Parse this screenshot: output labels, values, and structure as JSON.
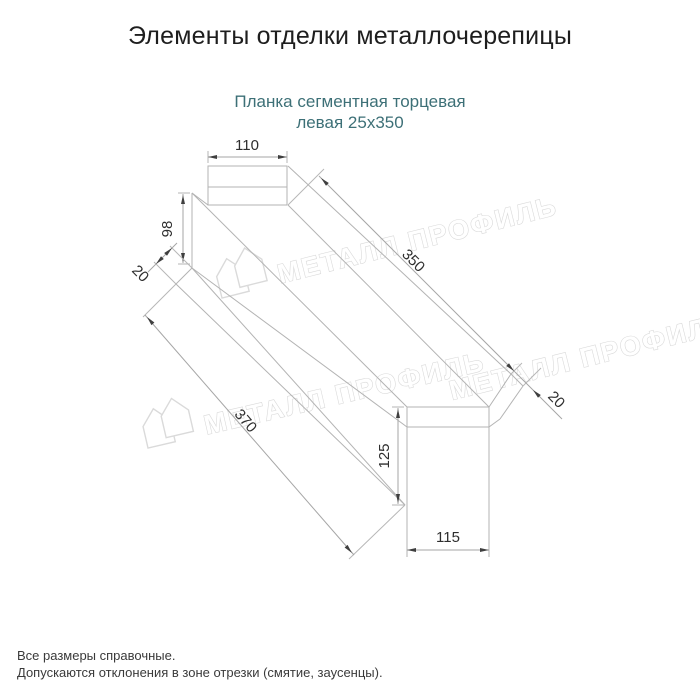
{
  "header": {
    "title": "Элементы отделки металлочерепицы"
  },
  "product": {
    "line1": "Планка сегментная торцевая",
    "line2": "левая 25х350"
  },
  "drawing": {
    "dim_top_width": "110",
    "dim_left_height": "98",
    "dim_left_flange": "20",
    "dim_length_top": "350",
    "dim_length_bottom": "370",
    "dim_right_flange": "20",
    "dim_right_height": "125",
    "dim_bottom_width": "115"
  },
  "watermark": {
    "text": "МЕТАЛЛ ПРОФИЛЬ"
  },
  "footer": {
    "line1": "Все размеры справочные.",
    "line2": "Допускаются отклонения в зоне отрезки (смятие, заусенцы)."
  },
  "colors": {
    "subtitle_teal": "#3d7077",
    "line_gray": "#b3b3b3",
    "dim_text": "#2e2e2e",
    "arrow": "#3f3f3f",
    "watermark_gray": "#d9d9d9"
  }
}
